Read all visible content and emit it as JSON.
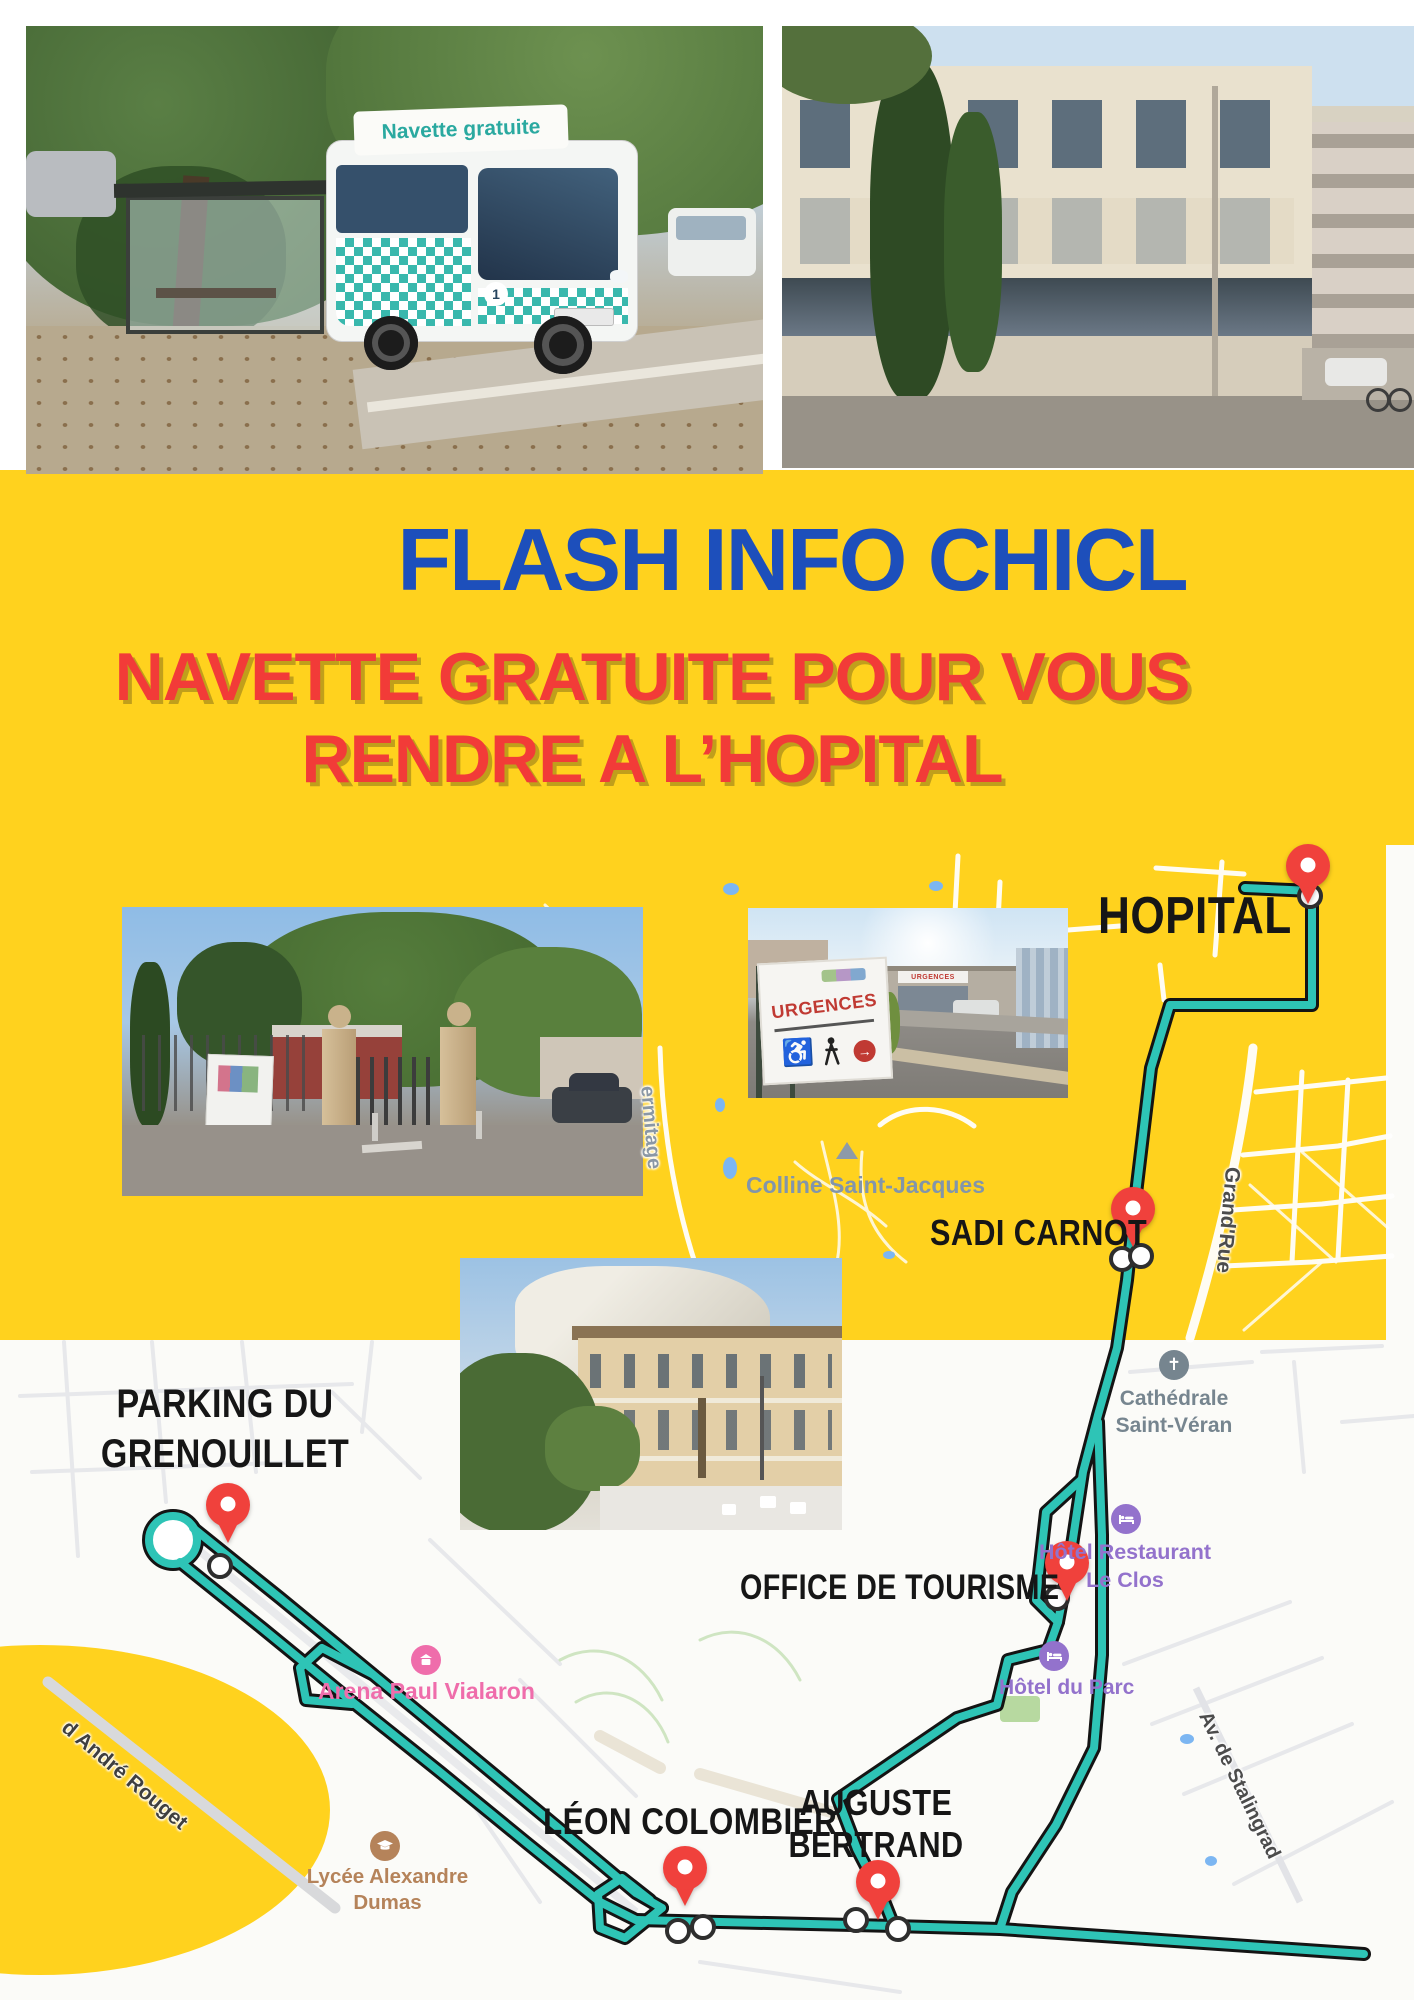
{
  "header": {
    "title": "FLASH INFO CHICL",
    "subtitle1": "NAVETTE GRATUITE POUR VOUS",
    "subtitle2": "RENDRE A L’HOPITAL"
  },
  "photos": {
    "bus": {
      "roof_sign": "Navette gratuite",
      "line_badge": "1"
    },
    "urgences": {
      "big_sign": "URGENCES",
      "entrance_sign": "URGENCES"
    }
  },
  "map": {
    "stops": {
      "hopital": {
        "label": "HOPITAL"
      },
      "sadi": {
        "label": "SADI CARNOT"
      },
      "office": {
        "label": "OFFICE DE TOURISME"
      },
      "parking": {
        "line1": "PARKING DU",
        "line2": "GRENOUILLET"
      },
      "leon": {
        "label": "LÉON COLOMBIER"
      },
      "auguste": {
        "line1": "AUGUSTE",
        "line2": "BERTRAND"
      }
    },
    "pois": {
      "colline": {
        "label": "Colline Saint-Jacques"
      },
      "cathedrale": {
        "line1": "Cathédrale",
        "line2": "Saint-Véran"
      },
      "leclos": {
        "line1": "Hôtel Restaurant",
        "line2": "Le Clos"
      },
      "parc": {
        "label": "Hôtel du Parc"
      },
      "arena": {
        "label": "Arena Paul Vialaron"
      },
      "lycee": {
        "line1": "Lycée Alexandre",
        "line2": "Dumas"
      }
    },
    "streets": {
      "grand_rue": {
        "label": "Grand'Rue"
      },
      "stalingrad": {
        "label": "Av. de Stalingrad"
      },
      "rouget": {
        "label": "d André Rouget"
      },
      "ermitage": {
        "label": "ermitage"
      }
    }
  },
  "colors": {
    "background_yellow": "#FFD21E",
    "title_blue": "#1D4FBB",
    "subtitle_red": "#F23B38",
    "route_teal": "#2EC4B6",
    "route_casing": "#141414",
    "pin_red": "#F0413C",
    "poi_purple": "#9372CC",
    "poi_pink": "#EF6DAB",
    "poi_brown": "#B5835A",
    "poi_gray_blue": "#8295AA"
  }
}
